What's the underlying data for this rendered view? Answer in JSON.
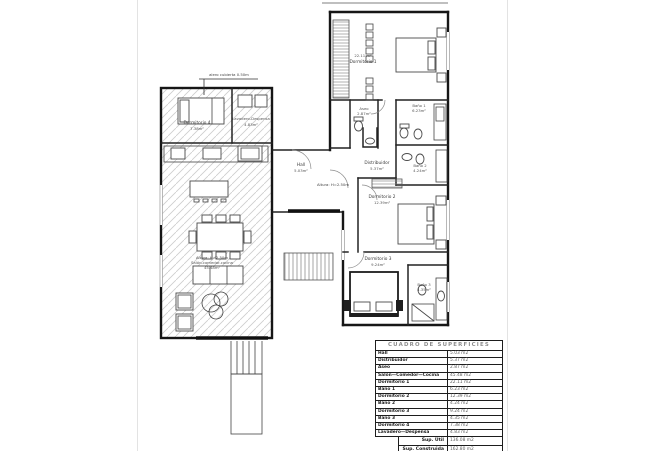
{
  "annotations": {
    "eave": "alero cubierta 0.50m",
    "altura_hall": "Altura: H=2.50m",
    "altura_salon": "Altura: H=2.50m"
  },
  "rooms": {
    "dormitorio1": {
      "area": "22.11 m²",
      "name": "Dormitorio 1"
    },
    "aseo": {
      "name": "Aseo",
      "area": "2.87m²"
    },
    "bano1": {
      "name": "Baño 1",
      "area": "6.23m²"
    },
    "distribuidor": {
      "name": "Distribuidor",
      "area": "5.37m²"
    },
    "hall": {
      "name": "Hall",
      "area": "5.03m²"
    },
    "dormitorio2": {
      "name": "Dormitorio 2",
      "area": "12.39m²"
    },
    "bano2": {
      "name": "Baño 2",
      "area": "4.24m²"
    },
    "dormitorio3": {
      "name": "Dormitorio 3",
      "area": "9.24m²"
    },
    "bano3": {
      "name": "Baño 3",
      "area": "4.35m²"
    },
    "dormitorio4": {
      "name": "Dormitorio 4",
      "area": "7.38m²"
    },
    "lavadero": {
      "name": "Lavadero-Despensa",
      "area": "4.83m²"
    },
    "salon": {
      "name": "Salón-comedor-cocina",
      "area": "45.48m²"
    }
  },
  "table": {
    "title": "CUADRO DE SUPERFICIES",
    "rows": [
      {
        "label": "Hall",
        "value": "5.03 m2"
      },
      {
        "label": "Distribuidor",
        "value": "5.37 m2"
      },
      {
        "label": "Aseo",
        "value": "2.87 m2"
      },
      {
        "label": "Salón—Comedor—Cocina",
        "value": "45.48 m2"
      },
      {
        "label": "Dormitorio 1",
        "value": "22.11 m2"
      },
      {
        "label": "Baño 1",
        "value": "6.23 m2"
      },
      {
        "label": "Dormitorio 2",
        "value": "12.39 m2"
      },
      {
        "label": "Baño 2",
        "value": "4.24 m2"
      },
      {
        "label": "Dormitorio 3",
        "value": "9.24 m2"
      },
      {
        "label": "Baño 3",
        "value": "4.35 m2"
      },
      {
        "label": "Dormitorio 4",
        "value": "7.38 m2"
      },
      {
        "label": "Lavadero—Despensa",
        "value": "4.83 m2"
      }
    ],
    "summary": [
      {
        "label": "Sup. Útil",
        "value": "136.08 m2"
      },
      {
        "label": "Sup. Construida",
        "value": "162.80 m2"
      }
    ]
  }
}
